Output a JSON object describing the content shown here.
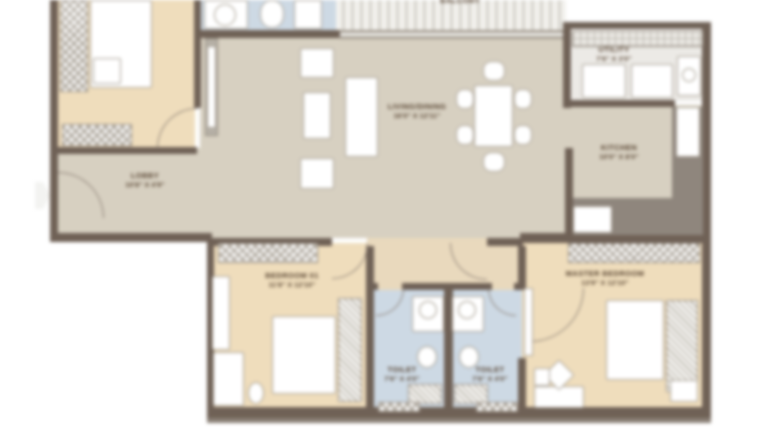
{
  "plan": {
    "type": "apartment-floor-plan",
    "colors": {
      "wall": "#6f6156",
      "bedroom_beige": "#efddbc",
      "living_greige": "#d7d0c1",
      "passage_beige": "#e9d9bd",
      "bath_blue": "#cdd9e4",
      "counter_gray": "#8f867d",
      "label_text": "#54402e"
    },
    "rooms": [
      {
        "id": "lobby",
        "name": "LOBBY",
        "dims": "10'8\" X 4'9\""
      },
      {
        "id": "living",
        "name": "LIVING/DINING",
        "dims": "16'0\" X 12'11\""
      },
      {
        "id": "kitchen",
        "name": "KITCHEN",
        "dims": "10'0\" X 8'0\""
      },
      {
        "id": "utility",
        "name": "UTILITY",
        "dims": "7'6\" X 3'0\""
      },
      {
        "id": "balcony",
        "name": "BALCONY",
        "dims": ""
      },
      {
        "id": "bedroom01",
        "name": "BEDROOM 01",
        "dims": "11'8\" X 12'10\""
      },
      {
        "id": "master",
        "name": "MASTER BEDROOM",
        "dims": "13'9\" X 12'10\""
      },
      {
        "id": "toilet1",
        "name": "TOILET",
        "dims": "7'6\" X 4'0\""
      },
      {
        "id": "toilet2",
        "name": "TOILET",
        "dims": "7'6\" X 4'0\""
      }
    ]
  }
}
